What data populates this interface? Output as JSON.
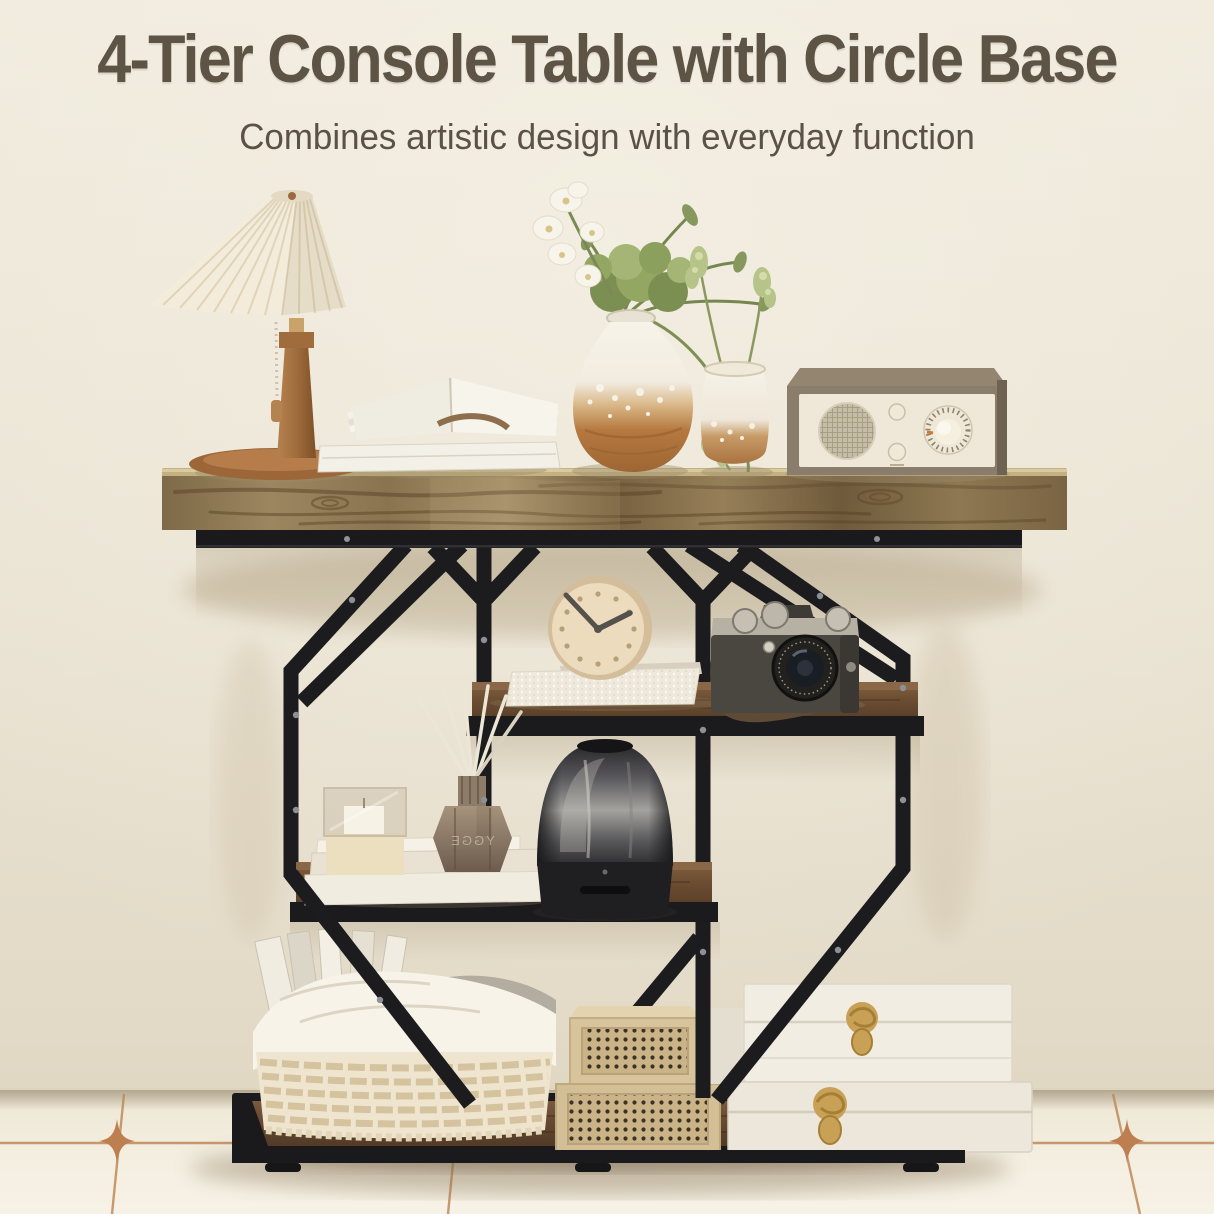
{
  "header": {
    "title": "4-Tier Console Table with Circle Base",
    "subtitle": "Combines artistic design with everyday function"
  },
  "scene": {
    "product": "4-tier console table with octagon black metal frame and rustic wood shelves",
    "diffuser_label": "YGGE",
    "objects": [
      "pleated-shade wooden table lamp with pull chain",
      "stack of books with open fanned book",
      "large ceramic vase with white orchid and greenery",
      "small glazed bud vase with green sprigs",
      "vintage tabletop radio with round grille and tuning dial",
      "round cream desk clock on textured white book",
      "retro film camera with leather strap",
      "stacked cream books",
      "glass candle box and cream box",
      "smoked-glass reed diffuser",
      "smoked-glass dome smart speaker",
      "woven rope basket with fabric liner and white files",
      "rattan-front wooden storage crates",
      "stacked white leather boxes with gold clasps"
    ],
    "colors": {
      "wall": "#e9e2d2",
      "floor": "#f4efe1",
      "tile_grout": "#c08a5a",
      "wood_top": "#8f7550",
      "wood_shelf": "#6d4e36",
      "metal_frame": "#1c1c1e",
      "gold_clasp": "#c8a157",
      "title_text": "#5d5446"
    }
  }
}
